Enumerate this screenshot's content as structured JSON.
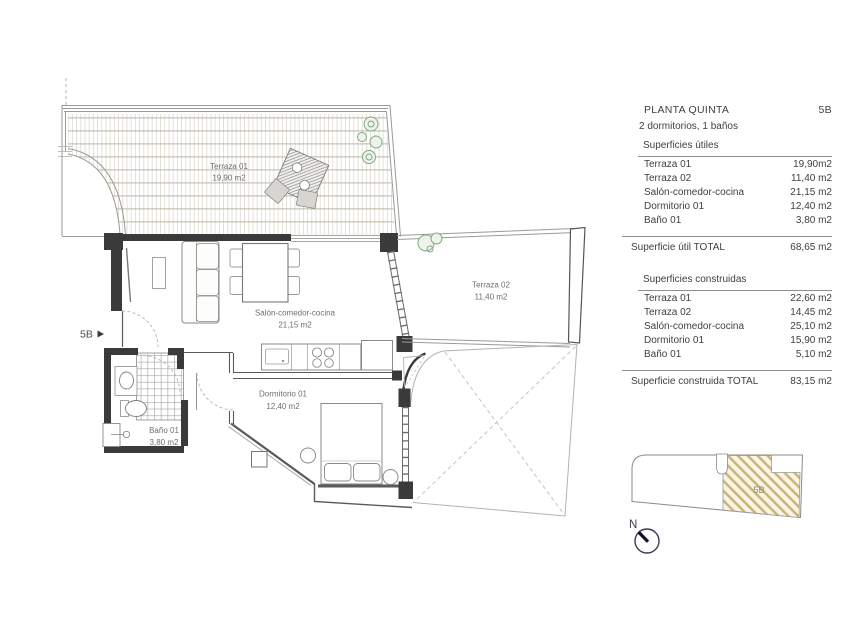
{
  "panel": {
    "title": "PLANTA QUINTA",
    "code": "5B",
    "subtitle": "2 dormitorios, 1 baños",
    "useful_title": "Superficies útiles",
    "useful_rows": [
      {
        "label": "Terraza 01",
        "value": "19,90m2"
      },
      {
        "label": "Terraza 02",
        "value": "11,40 m2"
      },
      {
        "label": "Salón-comedor-cocina",
        "value": "21,15 m2"
      },
      {
        "label": "Dormitorio 01",
        "value": "12,40 m2"
      },
      {
        "label": "Baño 01",
        "value": "3,80 m2"
      }
    ],
    "useful_total_label": "Superficie útil TOTAL",
    "useful_total_value": "68,65 m2",
    "built_title": "Superficies construidas",
    "built_rows": [
      {
        "label": "Terraza 01",
        "value": "22,60 m2"
      },
      {
        "label": "Terraza 02",
        "value": "14,45 m2"
      },
      {
        "label": "Salón-comedor-cocina",
        "value": "25,10 m2"
      },
      {
        "label": "Dormitorio 01",
        "value": "15,90 m2"
      },
      {
        "label": "Baño 01",
        "value": "5,10 m2"
      }
    ],
    "built_total_label": "Superficie construida TOTAL",
    "built_total_value": "83,15 m2"
  },
  "plan": {
    "entry_label": "5B",
    "rooms": {
      "terraza1": {
        "name": "Terraza 01",
        "area": "19,90 m2"
      },
      "terraza2": {
        "name": "Terraza 02",
        "area": "11,40 m2"
      },
      "salon": {
        "name": "Salón-comedor-cocina",
        "area": "21,15 m2"
      },
      "dormitorio": {
        "name": "Dormitorio 01",
        "area": "12,40 m2"
      },
      "bano": {
        "name": "Baño 01",
        "area": "3,80 m2"
      }
    }
  },
  "locator": {
    "unit_label": "5B",
    "north_label": "N"
  },
  "colors": {
    "wall": "#3a3a3a",
    "thin_line": "#9a9a96",
    "tan_hatch": "#c8b273",
    "plant": "#84a884"
  }
}
